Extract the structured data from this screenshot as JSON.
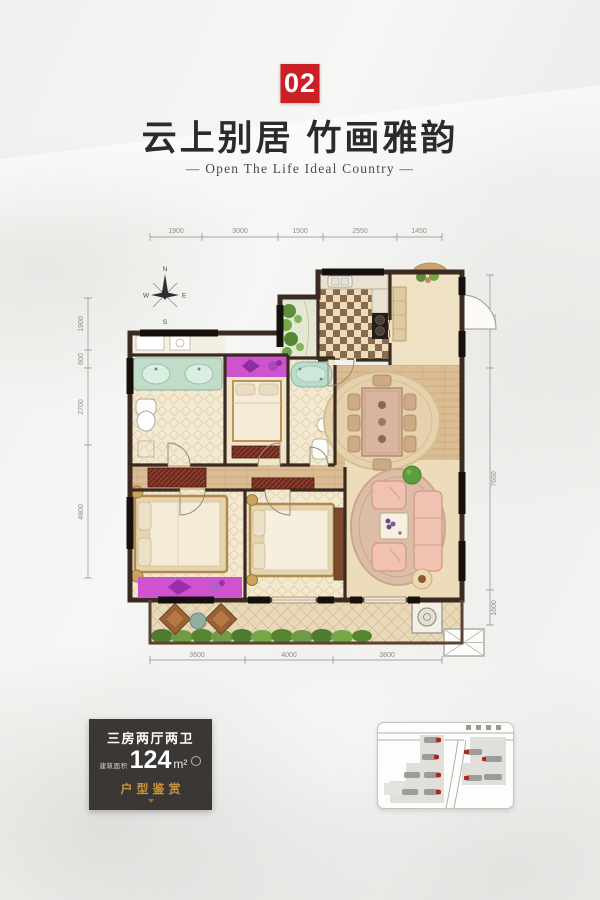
{
  "badge": {
    "number": "02"
  },
  "header": {
    "title": "云上别居 竹画雅韵",
    "subtitle": "— Open The Life Ideal  Country —"
  },
  "plan": {
    "compass": {
      "north": "N",
      "west": "W",
      "east": "E",
      "south": "S"
    },
    "dims_top": [
      "1900",
      "3000",
      "1500",
      "2550",
      "1450"
    ],
    "dims_left": [
      "1900",
      "600",
      "2700",
      "4800"
    ],
    "dims_right": [
      "3100",
      "7650",
      "1600"
    ],
    "dims_bottom": [
      "3600",
      "4000",
      "3800"
    ]
  },
  "info": {
    "layout_type": "三房两厅两卫",
    "area_label": "建筑面积",
    "area_value": "124",
    "area_unit": "m²",
    "tagline": "户型鉴赏"
  },
  "colors": {
    "badge_red": "#ca2026",
    "tagline_gold": "#c8953d",
    "info_bg": "#3a3734",
    "wall": "#3a2a21",
    "wardrobe_magenta": "#cf52cf"
  }
}
